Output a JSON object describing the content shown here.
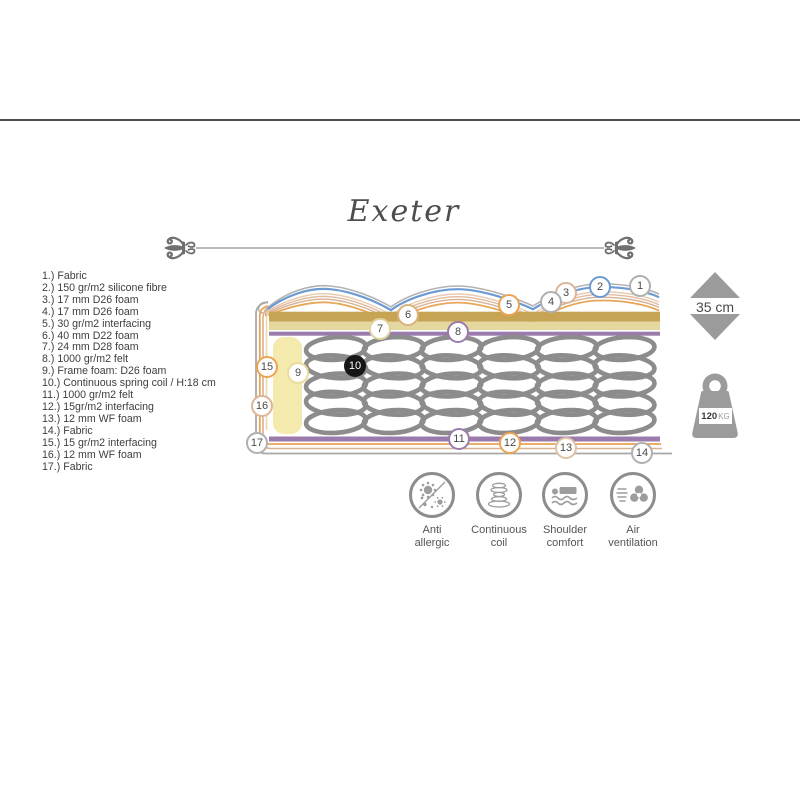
{
  "title": "Exeter",
  "spec_list": {
    "items": [
      {
        "num": "1.)",
        "text": "Fabric"
      },
      {
        "num": "2.)",
        "text": "150 gr/m2 silicone fibre"
      },
      {
        "num": "3.)",
        "text": "17 mm D26 foam"
      },
      {
        "num": "4.)",
        "text": "17 mm D26 foam"
      },
      {
        "num": "5.)",
        "text": "30 gr/m2 interfacing"
      },
      {
        "num": "6.)",
        "text": "40 mm D22 foam"
      },
      {
        "num": "7.)",
        "text": "24 mm D28 foam"
      },
      {
        "num": "8.)",
        "text": "1000 gr/m2 felt"
      },
      {
        "num": "9.)",
        "text": "Frame foam: D26 foam"
      },
      {
        "num": "10.)",
        "text": "Continuous spring coil / H:18 cm"
      },
      {
        "num": "11.)",
        "text": "1000 gr/m2 felt"
      },
      {
        "num": "12.)",
        "text": "15gr/m2 interfacing"
      },
      {
        "num": "13.)",
        "text": "12 mm WF foam"
      },
      {
        "num": "14.)",
        "text": "Fabric"
      },
      {
        "num": "15.)",
        "text": "15 gr/m2 interfacing"
      },
      {
        "num": "16.)",
        "text": "12 mm WF foam"
      },
      {
        "num": "17.)",
        "text": "Fabric"
      }
    ]
  },
  "callouts": [
    {
      "num": "1",
      "color": "#b0b0b0"
    },
    {
      "num": "2",
      "color": "#6c9bd4"
    },
    {
      "num": "3",
      "color": "#ddb596"
    },
    {
      "num": "4",
      "color": "#b0b0b0"
    },
    {
      "num": "5",
      "color": "#e9a455"
    },
    {
      "num": "6",
      "color": "#d9b27e"
    },
    {
      "num": "7",
      "color": "#e0d2a0"
    },
    {
      "num": "8",
      "color": "#9b7bab"
    },
    {
      "num": "9",
      "color": "#e9dc9a"
    },
    {
      "num": "10",
      "color": "#161616"
    },
    {
      "num": "11",
      "color": "#9b7bab"
    },
    {
      "num": "12",
      "color": "#e9a455"
    },
    {
      "num": "13",
      "color": "#dfc1a6"
    },
    {
      "num": "14",
      "color": "#b0b0b0"
    },
    {
      "num": "15",
      "color": "#e9a455"
    },
    {
      "num": "16",
      "color": "#ddb596"
    },
    {
      "num": "17",
      "color": "#b0b0b0"
    }
  ],
  "height_badge": {
    "value": "35 cm"
  },
  "weight_badge": {
    "value": "120",
    "unit": "KG"
  },
  "features": [
    {
      "icon": "anti-allergic-icon",
      "line1": "Anti",
      "line2": "allergic"
    },
    {
      "icon": "continuous-coil-icon",
      "line1": "Continuous",
      "line2": "coil"
    },
    {
      "icon": "shoulder-comfort-icon",
      "line1": "Shoulder",
      "line2": "comfort"
    },
    {
      "icon": "air-ventilation-icon",
      "line1": "Air",
      "line2": "ventilation"
    }
  ],
  "colors": {
    "gold_band": "#c7a454",
    "light_gold_band": "#e5d89e",
    "purple_band": "#9b7bab",
    "orange_line": "#e9a455",
    "tan_line": "#d8b193",
    "blue_quilt_line": "#6c9bd4",
    "gray_line": "#a8a8a8",
    "spring_gray": "#8c8c8c",
    "frame_foam_yellow": "#f4eaad",
    "callout_black": "#161616",
    "icon_gray": "#8d8d8d",
    "text_gray": "#3e3e3e"
  }
}
